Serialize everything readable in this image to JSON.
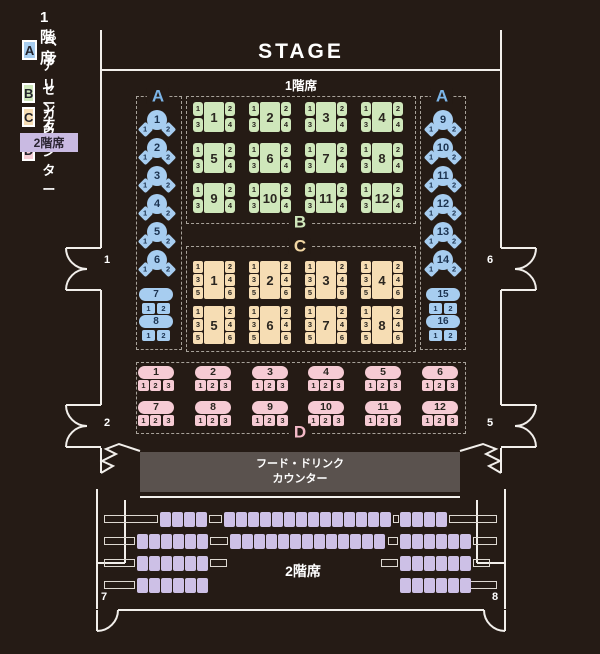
{
  "colors": {
    "background": "#251b15",
    "wall": "#f2efeb",
    "dash": "#a8a29a",
    "section_a": "#a7cdf0",
    "section_a_label": "#7cb5e8",
    "section_a_number": "#1c3350",
    "section_b": "#cfe7bb",
    "section_b_label": "#cfe7bb",
    "section_c": "#f6ddb4",
    "section_c_label": "#f2d7a4",
    "section_d": "#f6cbd4",
    "section_d_label": "#f3b9c7",
    "seat_number": "#2a2620",
    "floor2_seat": "#cdc0e6",
    "legend_2f_bg": "#c9bae2",
    "counter_bg": "#5a524e",
    "text_light": "#ffffff"
  },
  "legend": {
    "floor1_title": "1階席",
    "items": [
      {
        "letter": "A",
        "label": "ペア"
      },
      {
        "letter": "B",
        "label": "アリーナ"
      },
      {
        "letter": "C",
        "label": "センター"
      },
      {
        "letter": "D",
        "label": "カウンター"
      }
    ],
    "floor2_title": "2階席"
  },
  "stage": {
    "label": "STAGE"
  },
  "floor1": {
    "label": "1階席"
  },
  "floor2": {
    "label": "2階席"
  },
  "food_counter": {
    "line1": "フード・ドリンク",
    "line2": "カウンター"
  },
  "doors": {
    "d1": "1",
    "d2": "2",
    "d5": "5",
    "d6": "6",
    "d7": "7",
    "d8": "8"
  },
  "sections": {
    "a": {
      "label": "A",
      "seat_labels": [
        "1",
        "2"
      ],
      "left_pair_tables": [
        "1",
        "2",
        "3",
        "4",
        "5",
        "6"
      ],
      "left_counter_tables": [
        "7",
        "8"
      ],
      "right_pair_tables": [
        "9",
        "10",
        "11",
        "12",
        "13",
        "14"
      ],
      "right_counter_tables": [
        "15",
        "16"
      ]
    },
    "b": {
      "label": "B",
      "seat_labels": [
        "1",
        "2",
        "3",
        "4"
      ],
      "tables": [
        "1",
        "2",
        "3",
        "4",
        "5",
        "6",
        "7",
        "8",
        "9",
        "10",
        "11",
        "12"
      ]
    },
    "c": {
      "label": "C",
      "seat_labels": [
        "1",
        "2",
        "3",
        "4",
        "5",
        "6"
      ],
      "tables": [
        "1",
        "2",
        "3",
        "4",
        "5",
        "6",
        "7",
        "8"
      ]
    },
    "d": {
      "label": "D",
      "seat_labels": [
        "1",
        "2",
        "3"
      ],
      "counters": [
        "1",
        "2",
        "3",
        "4",
        "5",
        "6",
        "7",
        "8",
        "9",
        "10",
        "11",
        "12"
      ]
    }
  },
  "floor2_seating": {
    "rows": [
      {
        "groups": [
          {
            "side": "left",
            "seats": 4
          },
          {
            "side": "center",
            "seats": 14
          },
          {
            "side": "right",
            "seats": 4
          }
        ]
      },
      {
        "groups": [
          {
            "side": "left",
            "seats": 6
          },
          {
            "side": "center",
            "seats": 13
          },
          {
            "side": "right",
            "seats": 6
          }
        ]
      },
      {
        "groups": [
          {
            "side": "left",
            "seats": 6
          },
          {
            "side": "right",
            "seats": 6
          }
        ]
      },
      {
        "groups": [
          {
            "side": "left",
            "seats": 6
          },
          {
            "side": "right",
            "seats": 6
          }
        ]
      }
    ]
  }
}
